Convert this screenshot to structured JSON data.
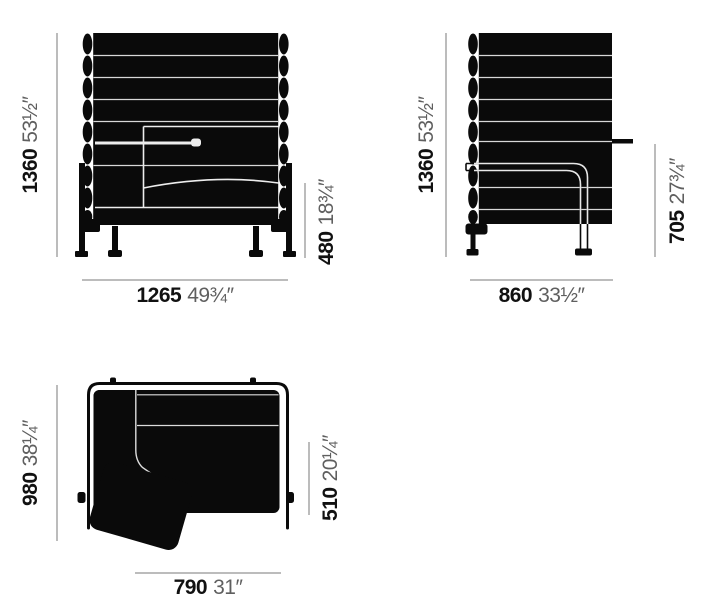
{
  "front_view": {
    "height_mm": "1360",
    "height_in": "53½″",
    "width_mm": "1265",
    "width_in": "49¾″",
    "seat_height_mm": "480",
    "seat_height_in": "18¾″"
  },
  "side_view": {
    "height_mm": "1360",
    "height_in": "53½″",
    "depth_mm": "860",
    "depth_in": "33½″",
    "table_height_mm": "705",
    "table_height_in": "27¾″"
  },
  "top_view": {
    "depth_mm": "980",
    "depth_in": "38¼″",
    "front_width_mm": "790",
    "front_width_in": "31″",
    "seat_depth_mm": "510",
    "seat_depth_in": "20¼″"
  },
  "colors": {
    "ink": "#0a0a0a",
    "detail_line": "#e3e3e3",
    "dim_line": "#7a7a7a",
    "mm_text": "#111111",
    "inch_text": "#5f5f5f"
  }
}
